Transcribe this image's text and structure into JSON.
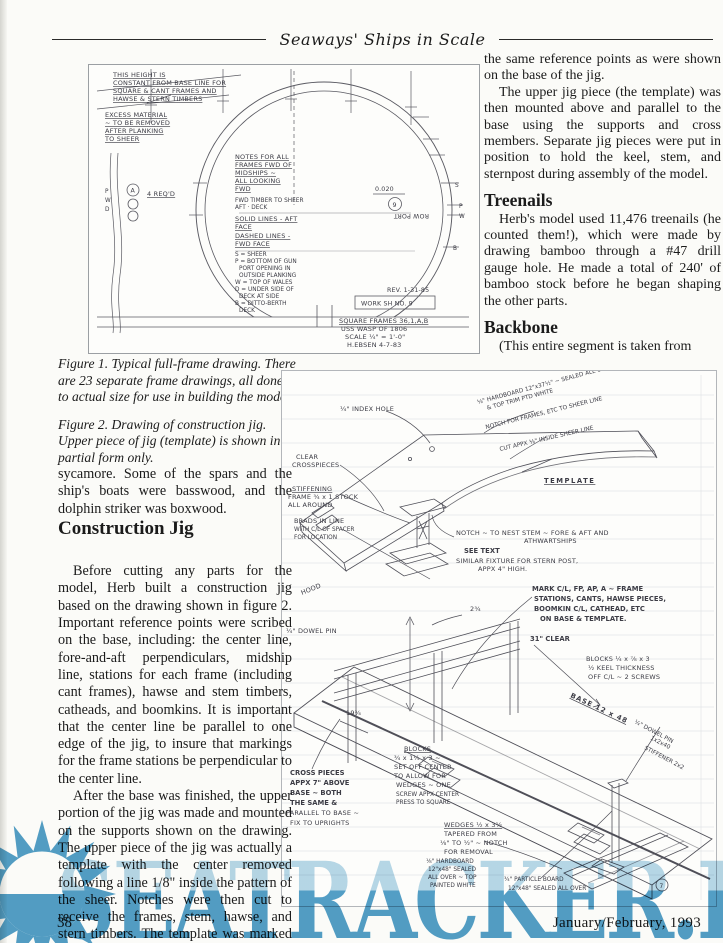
{
  "page": {
    "header_title": "Seaways' Ships in Scale",
    "page_number": "38",
    "footer_date": "January/February, 1993"
  },
  "right_column": {
    "para1": "the same reference points as were shown on the base of the jig.",
    "para2": "The upper jig piece (the template) was then mounted above and parallel to the base using the supports and cross members. Separate jig pieces were put in position to hold the keel, stem, and sternpost during assembly of the model.",
    "treenails_heading": "Treenails",
    "treenails_para": "Herb's model used 11,476 treenails (he counted them!), which were made by drawing bamboo through a #47 drill gauge hole. He made a total of 240' of bamboo stock before he began shaping the other parts.",
    "backbone_heading": "Backbone",
    "backbone_para": "(This entire segment is taken from"
  },
  "captions": {
    "figure1": "Figure 1. Typical full-frame drawing. There are 23 separate frame drawings, all done to actual size for use in building the model.",
    "figure2": "Figure 2. Drawing of construction jig. Upper piece of jig (template) is shown in partial form only."
  },
  "left_column": {
    "para1": "sycamore. Some of the spars and the ship's boats were basswood, and the dolphin striker was boxwood.",
    "construction_heading": "Construction Jig",
    "para2": "Before cutting any parts for the model, Herb built a construction jig based on the drawing shown in figure 2. Important reference points were scribed on the base, including:  the center line, fore-and-aft perpendiculars, midship line, stations for each frame (including cant frames), hawse and stem timbers, catheads, and boomkins. It is important that the center line be parallel to one edge of the jig, to insure that markings for the frame stations be perpendicular to the center line.",
    "para3": "After the base was finished, the upper portion of the jig was made and mounted on the supports shown on the drawing. The upper piece of the jig was actually a template with the center removed following a line 1/8\" inside the pattern of the sheer. Notches were then cut to receive the frames, stem, hawse, and stern timbers. The template was marked to indicate all"
  },
  "figure1": {
    "height_note": [
      "THIS HEIGHT IS",
      "CONSTANT FROM BASE LINE FOR",
      "SQUARE & CANT FRAMES AND",
      "HAWSE & STERN TIMBERS"
    ],
    "excess_note": [
      "EXCESS MATERIAL",
      "~ TO BE REMOVED",
      "AFTER PLANKING",
      "TO SHEER"
    ],
    "frames_note": [
      "NOTES FOR ALL",
      "FRAMES FWD OF",
      "MIDSHIPS ~",
      "ALL LOOKING",
      "FWD"
    ],
    "timber_note": [
      "FWD TIMBER TO SHEER",
      "AFT      ·      DECK"
    ],
    "solid_note": [
      "SOLID LINES - AFT",
      "FACE"
    ],
    "dashed_note": [
      "DASHED LINES -",
      "FWD FACE"
    ],
    "legend": [
      "S = SHEER",
      "P = BOTTOM OF GUN",
      "PORT OPENING IN",
      "OUTSIDE PLANKING",
      "W = TOP OF WALES",
      "D = UNDER SIDE OF",
      "DECK AT SIDE",
      "B = DITTO-BERTH",
      "DECK"
    ],
    "dim_0020": "0.020",
    "frame_circle": "9",
    "row_port": "ROW PORT",
    "marker_a": "A",
    "reqd": "4 REQ'D",
    "left_letters": [
      "P",
      "W",
      "D"
    ],
    "right_letters": [
      "S",
      "P",
      "W",
      "B"
    ],
    "rev": "REV. 1-31-85",
    "worksheet": "WORK SH NO. 9",
    "title_block": [
      "SQUARE FRAMES 36,1,A,B",
      "USS WASP OF 1806",
      "SCALE ¼\" = 1'-0\"",
      "H.EBSEN  4-7-83"
    ]
  },
  "figure2": {
    "index_hole": "¼\" INDEX HOLE",
    "hardboard_top": [
      "⅛\" HARDBOARD 12\"x37½\" ~ SEALED ALL OVER",
      "& TOP TRIM PTD WHITE"
    ],
    "notch_frames": "NOTCH FOR FRAMES, ETC TO SHEER LINE",
    "cut_appx": "CUT APPX ⅛\" INSIDE SHEER LINE",
    "template": "TEMPLATE",
    "clear_crosspieces": [
      "CLEAR",
      "CROSSPIECES"
    ],
    "stiffening": [
      "STIFFENING",
      "FRAME ¾ x 1 STOCK",
      "ALL AROUND"
    ],
    "brads": [
      "BRADS IN LINE",
      "WITH C/L OF SPACER",
      "FOR LOCATION"
    ],
    "nest_stem": [
      "NOTCH ~ TO NEST STEM ~ FORE & AFT AND",
      "ATHWARTSHIPS"
    ],
    "see_text": "SEE TEXT",
    "similar_fixture": [
      "SIMILAR FIXTURE FOR STERN POST,",
      "APPX 4\" HIGH."
    ],
    "mark_note": [
      "MARK C/L, FP, AP, A ~ FRAME",
      "STATIONS, CANTS, HAWSE PIECES,",
      "BOOMKIN C/L, CATHEAD, ETC",
      "ON BASE & TEMPLATE."
    ],
    "clear_31": "31\" CLEAR",
    "hood": "HOOD",
    "dowel_pin_left": "¼\" DOWEL PIN",
    "dim_2_34": "2¾",
    "dim_19_34": "19¾",
    "blocks_keel": [
      "BLOCKS ¼ x ⅞ x 3",
      "½ KEEL THICKNESS",
      "OFF C/L ~ 2 SCREWS"
    ],
    "base_dim": "BASE 12 x 48",
    "cross_pieces": [
      "CROSS PIECES",
      "APPX 7\" ABOVE",
      "BASE ~ BOTH",
      "THE SAME &",
      "PARALLEL TO BASE ~",
      "FIX TO UPRIGHTS"
    ],
    "blocks_center": [
      "BLOCKS",
      "¾ x 1¼ x 3 ~",
      "SET OFF CENTER",
      "TO ALLOW FOR",
      "WEDGES ~ ONE",
      "SCREW APPX CENTER",
      "PRESS TO SQUARE"
    ],
    "wedges": [
      "WEDGES ½ x 3½",
      "TAPERED FROM",
      "⅛\" TO ½\" ~ NOTCH",
      "FOR REMOVAL"
    ],
    "hardboard_bottom": [
      "⅛\" HARDBOARD",
      "12\"x48\" SEALED",
      "ALL OVER ~ TOP",
      "PAINTED WHITE"
    ],
    "particle_board": [
      "¾\" PARTICLE BOARD",
      "12\"x48\" SEALED ALL OVER"
    ],
    "circled_7": "7",
    "dowel_pin_right": "¼\" DOWEL PIN",
    "stiffener_right": [
      "1x2x40",
      "STIFFENER 2x2"
    ]
  },
  "watermark": {
    "text": "SEATRACKER.RU",
    "color": "#539fc8",
    "logo": "sunburst-logo"
  }
}
